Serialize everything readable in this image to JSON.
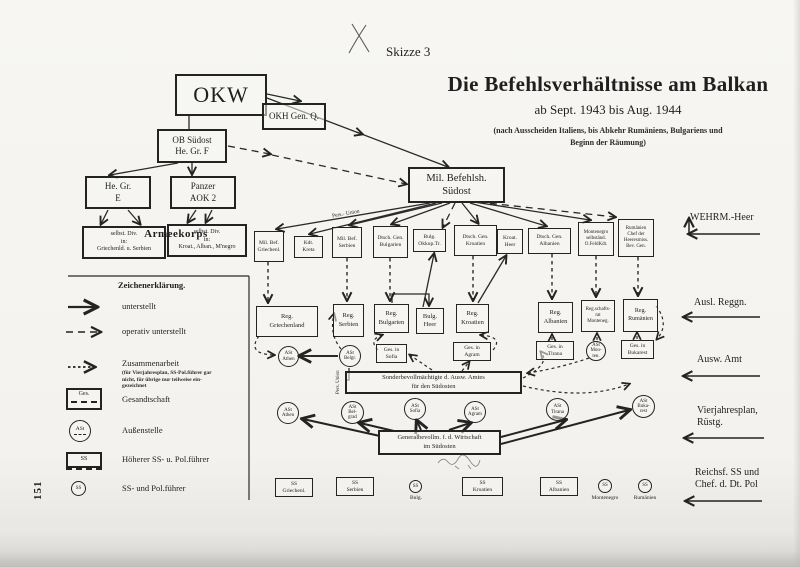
{
  "page": {
    "sketch_label": "Skizze 3",
    "page_number": "151",
    "title": "Die Befehlsverhältnisse am Balkan",
    "subtitle": "ab Sept. 1943 bis Aug. 1944",
    "note_line1": "(nach Ausscheiden Italiens, bis Abkehr Rumäniens, Bulgariens und",
    "note_line2": "Beginn der Räumung)"
  },
  "legend": {
    "title": "Zeichenerklärung.",
    "solid": "unterstellt",
    "dashed": "operativ unterstellt",
    "dotted": "Zusammenarbeit",
    "dotted_note": "(für Vierjahresplan, SS-Pol.führer gar\nnicht, für übrige nur teilweise ein-\ngezeichnet",
    "ges_symbol": "Ges.",
    "ges": "Gesandtschaft",
    "ast_symbol": "ASt",
    "ast": "Außenstelle",
    "hssf_symbol": "SS",
    "hssf": "Höherer SS- u. Pol.führer",
    "ssf_symbol": "SS",
    "ssf": "SS- und Pol.führer"
  },
  "right_labels": {
    "wehrm": "WEHRM.-Heer",
    "ausl": "Ausl. Reggn.",
    "ausw": "Ausw. Amt",
    "vierjahr": "Vierjahresplan,\nRüstg.",
    "reichsf": "Reichsf. SS und\nChef. d. Dt. Pol"
  },
  "annotations": {
    "pers_union_diag": "Pers.- Union",
    "pers_union_vert": "Pers. Union"
  },
  "nodes": {
    "okw": "OKW",
    "okh": "OKH Gen. Q.",
    "ob_suedost": "OB Südost\nHe. Gr. F",
    "hgr_e": "He. Gr.\nE",
    "pz_aok2": "Panzer\nAOK 2",
    "armeekorps": "Armeekorps",
    "div_west": "selbst. Div.\nin:\nGriechenld. u. Serbien",
    "div_ost": "selbst. Div.\nin:\nKroat., Alban., M'negro",
    "mil_bef_suedost": "Mil. Befehlsh.\nSüdost",
    "mb_griechenl": "Mil. Bef.\nGriechenl.",
    "kdt_kreta": "Kdt.\nKreta",
    "mb_serbien": "Mil. Bef.\nSerbien",
    "dg_bulgarien": "Dtsch. Gen.\nBulgarien",
    "bulg_okkup": "Bulg.\nOkkup.Tr.",
    "dg_kroatien": "Dtsch. Gen.\nKroatien",
    "kroat_heer": "Kroat.\nHeer",
    "dg_albanien": "Dtsch. Gen.\nAlbanien",
    "montenegro_kdt": "Montenegro\nselbständ.\nO.FeldKdt.",
    "rum_chef": "Rumänien\nChef der\nHeeresmiss.\nBev. Gen.",
    "reg_griechenland": "Reg.\nGriechenland",
    "reg_serbien": "Reg.\nSerbien",
    "reg_bulgarien": "Reg.\nBulgarien",
    "bulg_heer": "Bulg.\nHeer",
    "reg_kroatien": "Reg.\nKroatien",
    "reg_albanien": "Reg.\nAlbanien",
    "regschaftsrat": "Reg.schafts-\nrat\nMonteneg.",
    "reg_rumaenien": "Reg.\nRumänien",
    "ast_athen_1": "ASt\nAthen",
    "ast_belgr": "ASt\nBelgr.",
    "ges_sofia": "Ges. in\nSofia",
    "ges_agram": "Ges. in\nAgram",
    "ges_tirana": "Ges. in\nTirana",
    "ast_monten": "ASt\nMon-\nten.",
    "ges_bukarest": "Ges. in\nBukarest",
    "sonderbev": "Sonderbevollmächtigte d. Ausw. Amtes\nfür den Südosten",
    "ast_athen_2": "ASt\nAthen",
    "ast_belgrad": "ASt\nBel-\ngrad",
    "ast_sofia": "ASt\nSofia",
    "ast_agram2": "ASt\nAgram",
    "ast_tirana": "ASt\nTirana",
    "ast_bukarest": "ASt\nBuka-\nrest",
    "generalbev": "Generalbevollm. f. d. Wirtschaft\nim Südosten",
    "ss_griechenl": "SS\nGriechenl.",
    "ss_serbien": "SS\nSerbien",
    "ss_bulg_sym": "SS",
    "ss_bulg_lbl": "Bulg.",
    "ss_kroatien": "SS\nKroatien",
    "ss_albanien": "SS\nAlbanien",
    "ss_monte_sym": "SS",
    "ss_monte_lbl": "Montenegro",
    "ss_rum_sym": "SS",
    "ss_rum_lbl": "Rumänien"
  }
}
